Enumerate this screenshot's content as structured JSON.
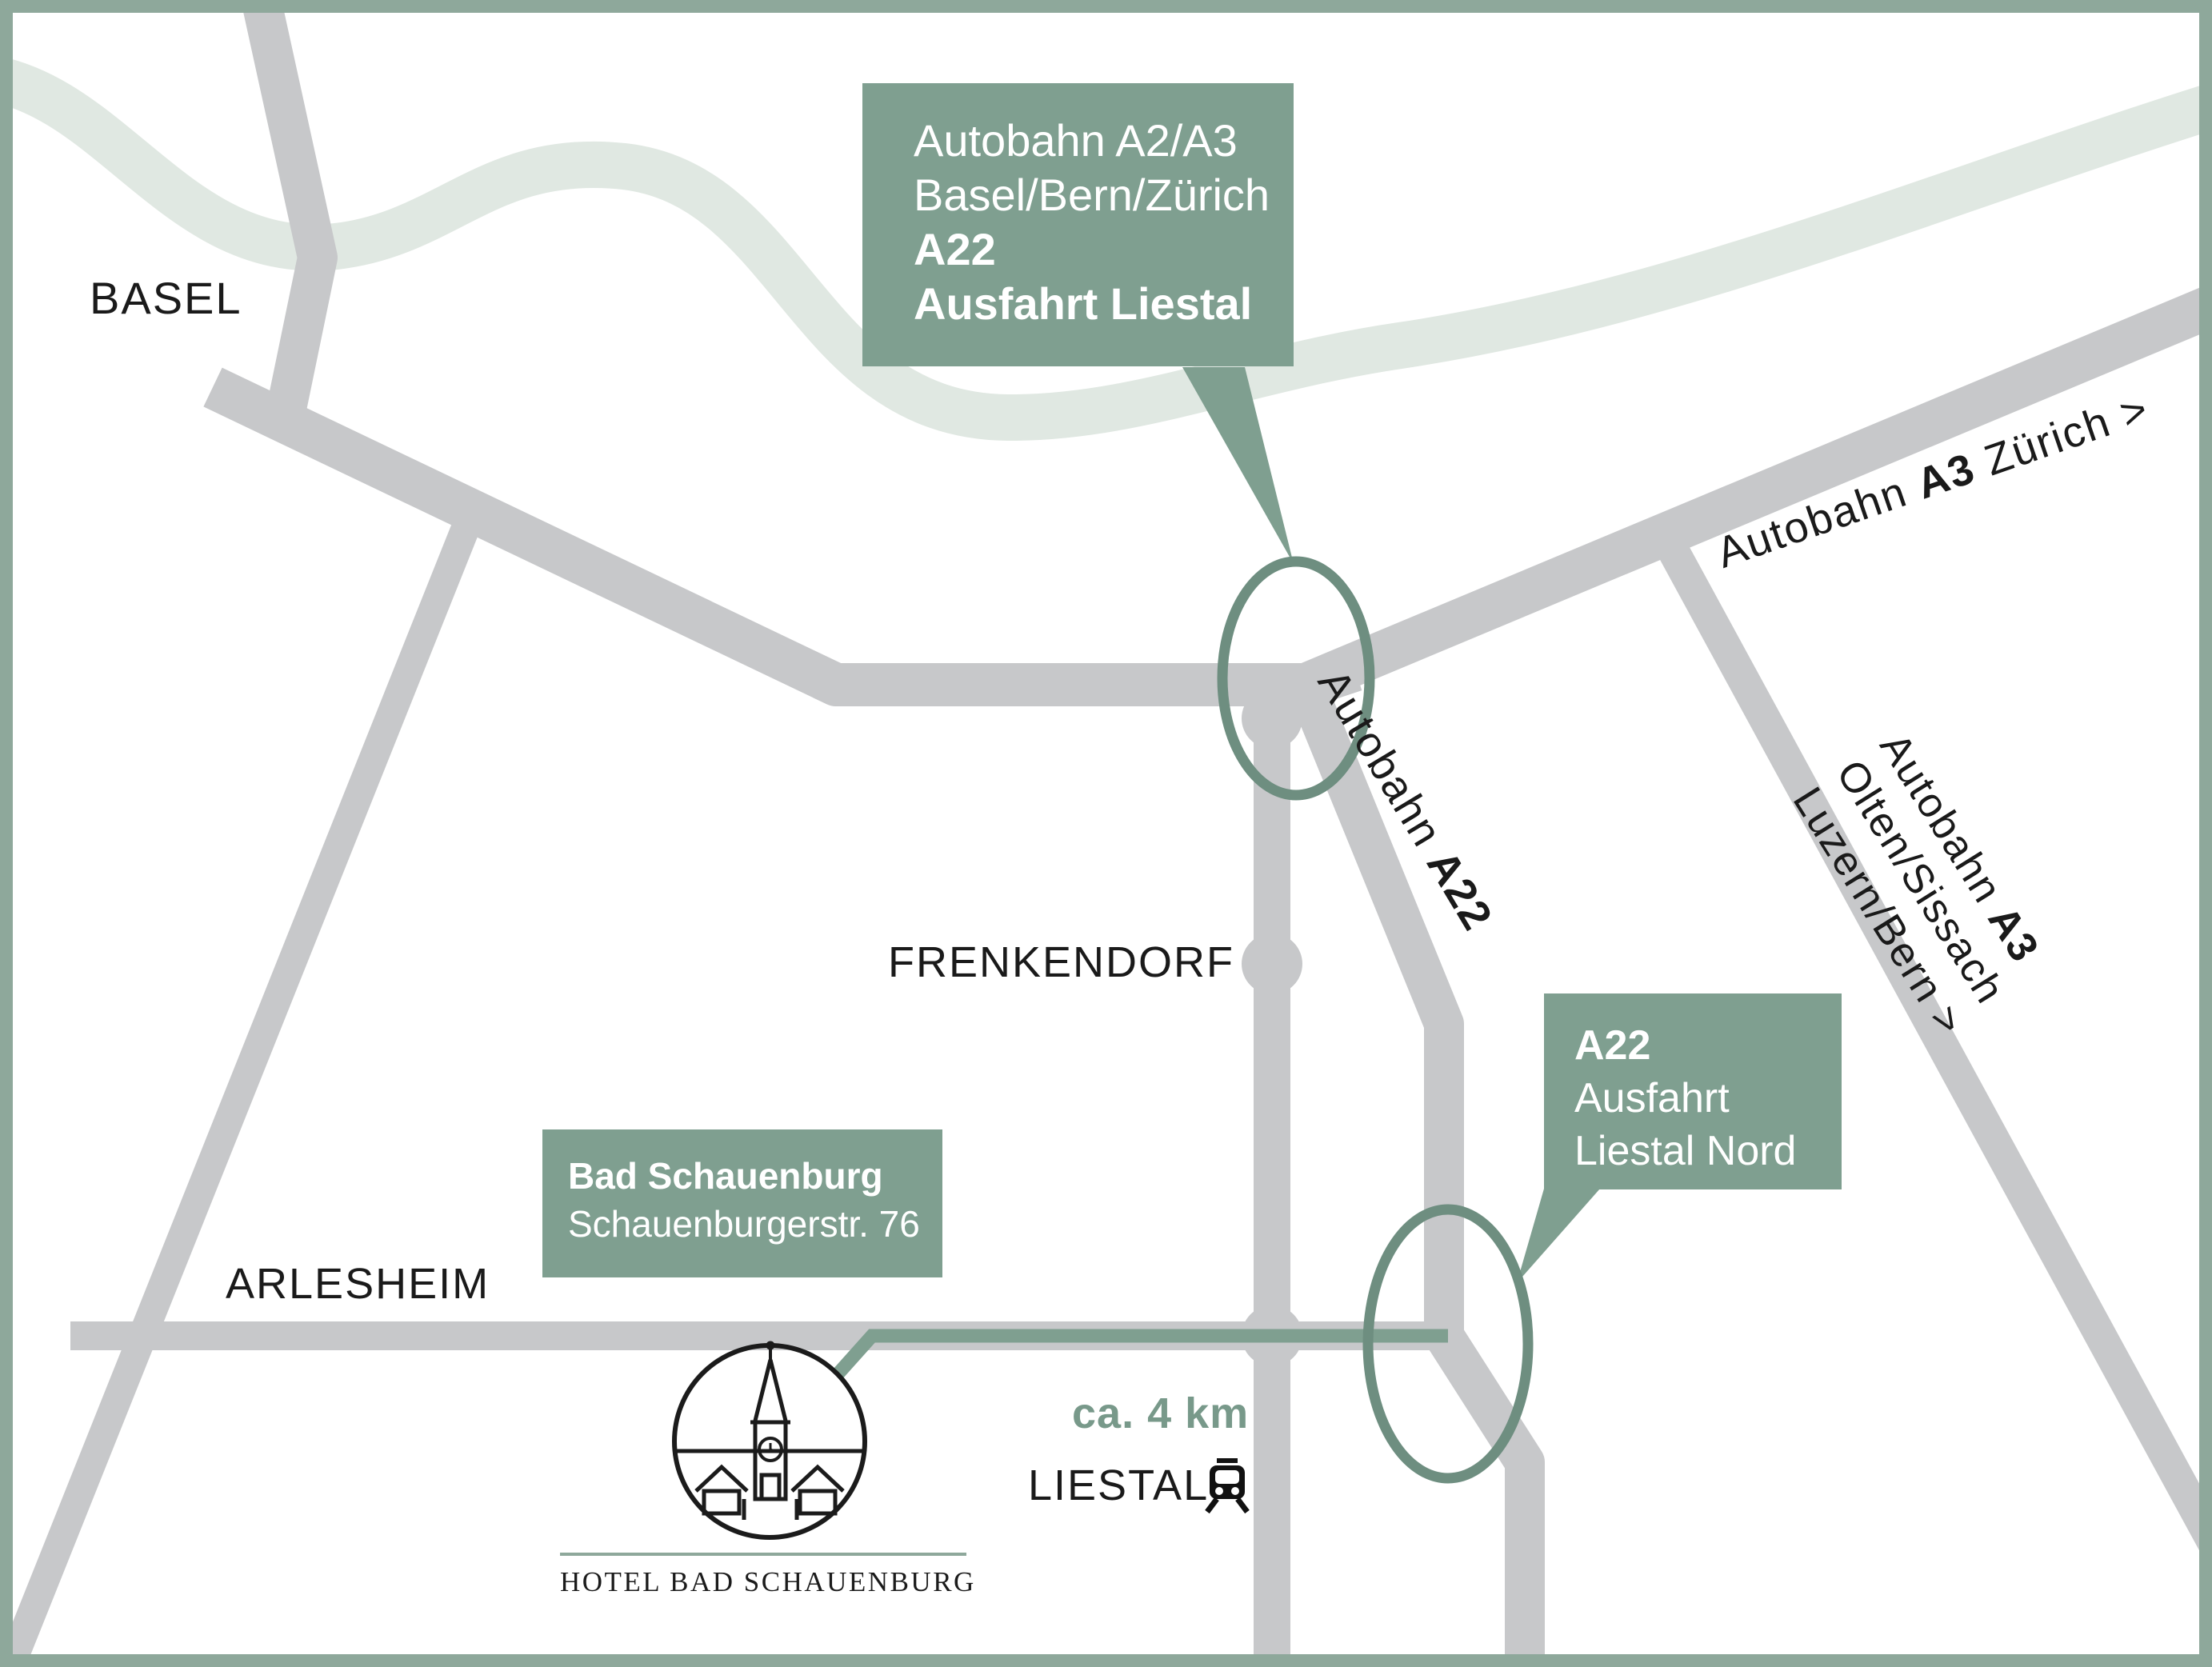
{
  "colors": {
    "accent_green": "#7F9F90",
    "frame_green": "#8EA89B",
    "pale_band": "#E0E8E2",
    "road_gray": "#C7C8CA",
    "circle_green": "#6E8E80",
    "distance_green": "#78998A",
    "text_dark": "#1A1A1A"
  },
  "places": {
    "basel": "BASEL",
    "arlesheim": "ARLESHEIM",
    "frenkendorf": "FRENKENDORF",
    "liestal": "LIESTAL"
  },
  "callout_exit_liestal": {
    "line1": "Autobahn A2/A3",
    "line2": "Basel/Bern/Zürich",
    "line3": "A22",
    "line4": "Ausfahrt Liestal"
  },
  "callout_exit_liestal_nord": {
    "line1": "A22",
    "line2": "Ausfahrt",
    "line3": "Liestal Nord"
  },
  "callout_hotel": {
    "line1": "Bad Schauenburg",
    "line2": "Schauenburgerstr. 76"
  },
  "road_labels": {
    "a3_zurich": {
      "pre": "Autobahn ",
      "hwy": "A3",
      "post": " Zürich >"
    },
    "a22": {
      "pre": "Autobahn ",
      "hwy": "A22"
    },
    "a3_south": {
      "line1_pre": "Autobahn ",
      "line1_hwy": "A3",
      "line2": "Olten/Sissach",
      "line3": "Luzern/Bern >"
    }
  },
  "distance_label": "ca. 4 km",
  "hotel_caption": "HOTEL BAD SCHAUENBURG"
}
